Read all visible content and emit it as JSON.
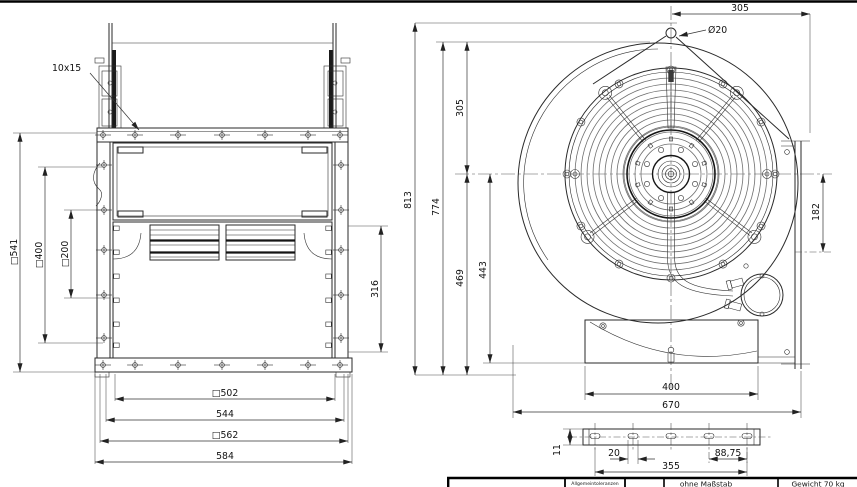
{
  "side_view": {
    "slot_callout": "10x15",
    "dim_sq541": "□541",
    "dim_sq400": "□400",
    "dim_sq200": "□200",
    "dim_316": "316",
    "dim_sq502": "□502",
    "dim_544": "544",
    "dim_sq562": "□562",
    "dim_584": "584"
  },
  "front_view": {
    "dim_305_top": "305",
    "dim_dia20": "Ø20",
    "dim_813": "813",
    "dim_774": "774",
    "dim_305_left": "305",
    "dim_469": "469",
    "dim_443": "443",
    "dim_182": "182",
    "dim_400": "400",
    "dim_670": "670"
  },
  "rail_detail": {
    "dim_11": "11",
    "dim_20": "20",
    "dim_88_75": "88,75",
    "dim_355": "355"
  },
  "title_block": {
    "tolerances_label": "Allgemeintoleranzen",
    "scale_label": "ohne Maßstab",
    "weight_label": "Gewicht 70 kg"
  },
  "colors": {
    "line": "#2a2a2a",
    "dim": "#333333",
    "rings": "#6f6f6f",
    "background": "#ffffff"
  }
}
